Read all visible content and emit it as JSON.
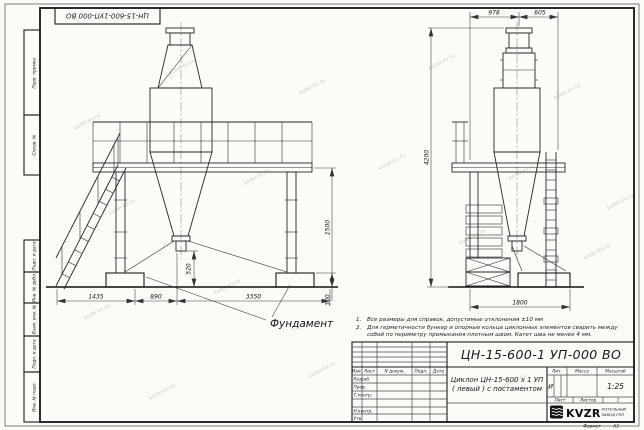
{
  "watermark": "kotel-kv.ru",
  "stamp_top_left": "ЦН-15-600-1УП-000  ВО",
  "side_column": {
    "cells": [
      "Перв. примен.",
      "Справ. №",
      "Подп. и дата",
      "Инв. № дубл.",
      "Взам. инв. №",
      "Подп. и дата",
      "Инв. № подл."
    ]
  },
  "notes": [
    {
      "num": "1.",
      "text": "Все размеры для справок, допустимые отклонения ±10 мм"
    },
    {
      "num": "2.",
      "text": "Для герметичности бункер и опорные кольца циклонных элементов сварить между собой по периметру примыкания плотным швом. Катет шва не менее 4 мм."
    }
  ],
  "drawing": {
    "foundation_label": "Фундамент",
    "dims": {
      "top_span_left": "978",
      "top_span_right": "605",
      "total_height": "4200",
      "platform_height": "1500",
      "outlet_clearance": "520",
      "foundation_height": "300",
      "stair_run": "1435",
      "mid_span": "890",
      "support_span": "3350",
      "side_width": "1800"
    }
  },
  "title_block": {
    "doc_number": "ЦН-15-600-1 УП-000  ВО",
    "product_line1": "Циклон ЦН-15-600 х 1 УП",
    "product_line2": "( левый )  с постаментом",
    "col_headers": [
      "Изм.",
      "Лист",
      "N докум.",
      "Подп.",
      "Дата"
    ],
    "row_labels": [
      "Разраб.",
      "Пров.",
      "Т.контр.",
      "Н.контр.",
      "Утв."
    ],
    "lit_label": "Лит.",
    "lit_value": "И",
    "mass_label": "Масса",
    "scale_label": "Масштаб",
    "scale_value": "1:25",
    "sheet_label": "Лист",
    "sheets_label": "Листов",
    "sheets_value": "1",
    "logo_text": "KVZR",
    "logo_caption1": "КОТЕЛЬНЫЙ",
    "logo_caption2": "ЗАВОД РЭП",
    "format_label": "Формат",
    "format_value": "А3"
  }
}
